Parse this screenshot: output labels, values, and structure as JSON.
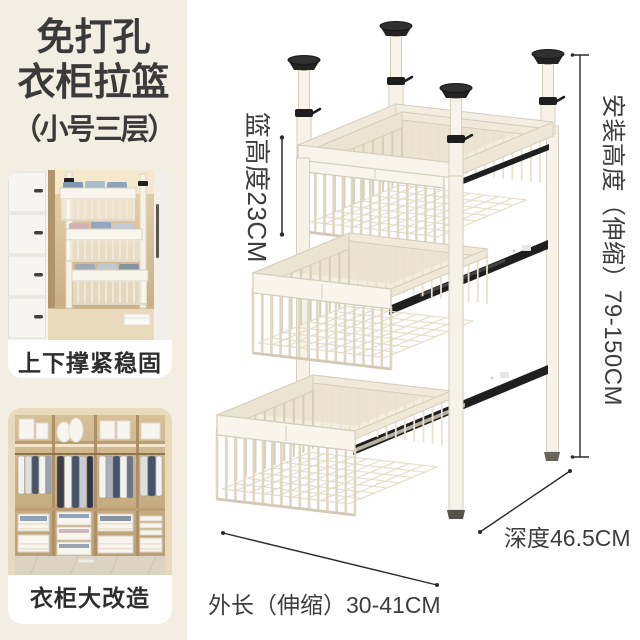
{
  "title": {
    "line1": "免打孔",
    "line2": "衣柜拉篮",
    "line3": "（小号三层）"
  },
  "cards": [
    {
      "caption": "上下撑紧稳固"
    },
    {
      "caption": "衣柜大改造"
    }
  ],
  "dimensions": {
    "basket_height": "篮高度23CM",
    "install_height": "安装高度（伸缩）79-150CM",
    "depth": "深度46.5CM",
    "outer_length": "外长（伸缩）30-41CM"
  },
  "colors": {
    "sidebar_bg": "#f2eee2",
    "card_bg": "#ffffff",
    "text_dark": "#3a3a3a",
    "metal_cream": "#f6f2e8",
    "metal_stroke": "#d6cebb",
    "rail_black": "#1f1f1f",
    "measure_line": "#2b2b2b"
  }
}
